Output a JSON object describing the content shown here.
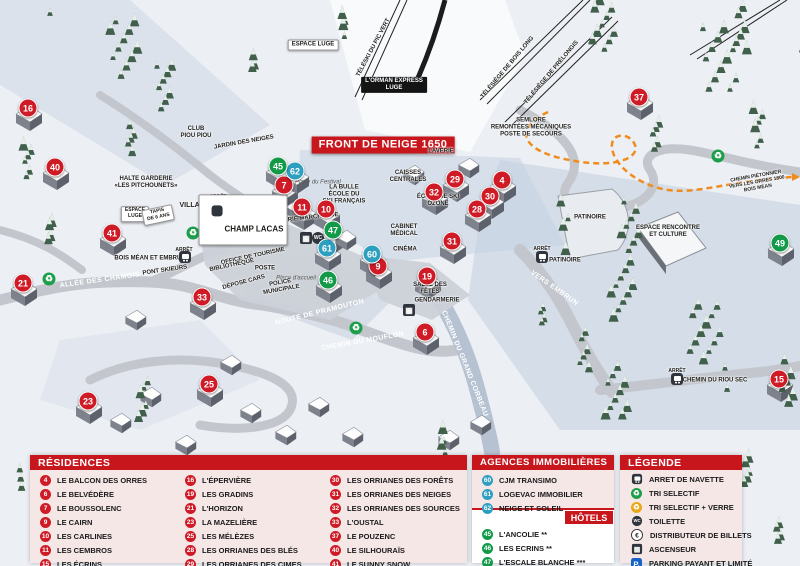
{
  "colors": {
    "residence": "#cf1b26",
    "agency": "#2d9fc0",
    "hotel": "#129a49",
    "header_red": "#c8161d",
    "panel_pink": "#f6e7e7",
    "path_orange": "#f08c1e"
  },
  "map": {
    "front_banner": "FRONT DE NEIGE 1650",
    "markers": [
      {
        "n": "16",
        "t": "residence",
        "x": 28,
        "y": 108
      },
      {
        "n": "40",
        "t": "residence",
        "x": 55,
        "y": 167
      },
      {
        "n": "41",
        "t": "residence",
        "x": 112,
        "y": 233
      },
      {
        "n": "21",
        "t": "residence",
        "x": 23,
        "y": 283
      },
      {
        "n": "33",
        "t": "residence",
        "x": 202,
        "y": 297
      },
      {
        "n": "23",
        "t": "residence",
        "x": 88,
        "y": 401
      },
      {
        "n": "25",
        "t": "residence",
        "x": 209,
        "y": 384
      },
      {
        "n": "7",
        "t": "residence",
        "x": 284,
        "y": 185
      },
      {
        "n": "11",
        "t": "residence",
        "x": 302,
        "y": 207
      },
      {
        "n": "10",
        "t": "residence",
        "x": 326,
        "y": 209
      },
      {
        "n": "9",
        "t": "residence",
        "x": 378,
        "y": 266
      },
      {
        "n": "29",
        "t": "residence",
        "x": 455,
        "y": 179
      },
      {
        "n": "32",
        "t": "residence",
        "x": 434,
        "y": 192
      },
      {
        "n": "4",
        "t": "residence",
        "x": 502,
        "y": 180
      },
      {
        "n": "30",
        "t": "residence",
        "x": 490,
        "y": 196
      },
      {
        "n": "28",
        "t": "residence",
        "x": 477,
        "y": 209
      },
      {
        "n": "31",
        "t": "residence",
        "x": 452,
        "y": 241
      },
      {
        "n": "19",
        "t": "residence",
        "x": 427,
        "y": 276
      },
      {
        "n": "6",
        "t": "residence",
        "x": 425,
        "y": 332
      },
      {
        "n": "37",
        "t": "residence",
        "x": 639,
        "y": 97
      },
      {
        "n": "15",
        "t": "residence",
        "x": 779,
        "y": 379
      },
      {
        "n": "62",
        "t": "agency",
        "x": 295,
        "y": 171
      },
      {
        "n": "61",
        "t": "agency",
        "x": 327,
        "y": 248
      },
      {
        "n": "60",
        "t": "agency",
        "x": 372,
        "y": 254
      },
      {
        "n": "45",
        "t": "hotel",
        "x": 278,
        "y": 166
      },
      {
        "n": "47",
        "t": "hotel",
        "x": 333,
        "y": 230
      },
      {
        "n": "46",
        "t": "hotel",
        "x": 328,
        "y": 280
      },
      {
        "n": "49",
        "t": "hotel",
        "x": 780,
        "y": 243
      }
    ],
    "labels": [
      {
        "text": "ESPACE LUGE",
        "x": 313,
        "y": 45,
        "style": "boxw",
        "size": 6
      },
      {
        "text": "TÉLÉSKI DU PIC VERT",
        "x": 374,
        "y": 48,
        "style": "plain",
        "rot": -62,
        "size": 6
      },
      {
        "text": "L'ORMAN EXPRESS\nLUGE",
        "x": 394,
        "y": 85,
        "style": "boxb",
        "size": 6
      },
      {
        "text": "TÉLÉSIÈGE DE BOIS LONG",
        "x": 508,
        "y": 68,
        "style": "plain",
        "rot": -50,
        "size": 6
      },
      {
        "text": "TÉLÉSIÈGE DE PRÉLONGIS",
        "x": 552,
        "y": 73,
        "style": "plain",
        "rot": -50,
        "size": 6
      },
      {
        "text": "FRONT DE NEIGE 1650",
        "x": 383,
        "y": 145,
        "style": "boxr",
        "size": 11
      },
      {
        "text": "SEMLORE\nREMONTÉES MÉCANIQUES\nPOSTE DE SECOURS",
        "x": 531,
        "y": 128,
        "style": "plain",
        "size": 6
      },
      {
        "text": "CLUB\nPIOU PIOU",
        "x": 196,
        "y": 133,
        "style": "plain",
        "size": 6
      },
      {
        "text": "JARDIN DES NEIGES",
        "x": 244,
        "y": 143,
        "style": "plain",
        "rot": -10,
        "size": 6
      },
      {
        "text": "HALTE GARDERIE\n«LES PITCHOUNETS»",
        "x": 146,
        "y": 183,
        "style": "plain",
        "size": 6
      },
      {
        "text": "VILLAGES",
        "x": 197,
        "y": 206,
        "style": "plain",
        "size": 7
      },
      {
        "text": "ARRÊT",
        "x": 218,
        "y": 198,
        "style": "tiny",
        "size": 5
      },
      {
        "text": "ESPACE\nLUGE",
        "x": 135,
        "y": 214,
        "style": "boxw",
        "size": 5
      },
      {
        "text": "TAPIS\nDE 6 ANS",
        "x": 158,
        "y": 215,
        "style": "boxw",
        "rot": -12,
        "size": 5
      },
      {
        "text": "LA BULLE\nÉCOLE DU\nSKI FRANÇAIS",
        "x": 344,
        "y": 195,
        "style": "plain",
        "size": 6
      },
      {
        "text": "Place du Festival",
        "x": 318,
        "y": 183,
        "style": "italic",
        "size": 6
      },
      {
        "text": "GALERIE MARCHANDE",
        "x": 305,
        "y": 219,
        "style": "plain",
        "rot": -6,
        "size": 6
      },
      {
        "text": "CAISSES\nCENTRALES",
        "x": 408,
        "y": 177,
        "style": "plain",
        "size": 6
      },
      {
        "text": "LAVERIE",
        "x": 441,
        "y": 152,
        "style": "plain",
        "size": 6
      },
      {
        "text": "ÉCOLE DE SKI\nOZONE",
        "x": 438,
        "y": 201,
        "style": "plain",
        "size": 6
      },
      {
        "text": "CABINET\nMÉDICAL",
        "x": 404,
        "y": 231,
        "style": "plain",
        "size": 6
      },
      {
        "text": "CINÉMA",
        "x": 405,
        "y": 250,
        "style": "plain",
        "size": 6
      },
      {
        "text": "Place d'accueil",
        "x": 296,
        "y": 279,
        "style": "italic",
        "size": 6
      },
      {
        "text": "OFFICE DE TOURISME",
        "x": 253,
        "y": 257,
        "style": "plain",
        "rot": -12,
        "size": 6
      },
      {
        "text": "BIBLIOTHÈQUE",
        "x": 232,
        "y": 266,
        "style": "plain",
        "rot": -12,
        "size": 6
      },
      {
        "text": "POSTE",
        "x": 265,
        "y": 269,
        "style": "plain",
        "size": 6
      },
      {
        "text": "DÉPOSE CARS",
        "x": 244,
        "y": 283,
        "style": "plain",
        "rot": -15,
        "size": 6
      },
      {
        "text": "POLICE\nMUNICIPALE",
        "x": 281,
        "y": 287,
        "style": "plain",
        "rot": -10,
        "size": 6
      },
      {
        "text": "SALLE DES\nFÊTES",
        "x": 430,
        "y": 289,
        "style": "plain",
        "size": 6
      },
      {
        "text": "GENDARMERIE",
        "x": 437,
        "y": 301,
        "style": "plain",
        "size": 6
      },
      {
        "text": "BOIS MÉAN ET EMBRUN",
        "x": 150,
        "y": 259,
        "style": "plain",
        "size": 6
      },
      {
        "text": "ARRÊT",
        "x": 184,
        "y": 251,
        "style": "tiny",
        "size": 5
      },
      {
        "text": "PONT SKIEURS",
        "x": 165,
        "y": 271,
        "style": "plain",
        "rot": -8,
        "size": 6
      },
      {
        "text": "ALLÉE DES CHAMOIS",
        "x": 100,
        "y": 281,
        "style": "road",
        "rot": -8,
        "size": 7
      },
      {
        "text": "ROUTE DE PRAMOUTON",
        "x": 320,
        "y": 313,
        "style": "road",
        "rot": -14,
        "size": 7
      },
      {
        "text": "CHEMIN DU MOUFLON",
        "x": 363,
        "y": 342,
        "style": "road",
        "rot": -10,
        "size": 7
      },
      {
        "text": "CHEMIN DU GRAND CORBEAU",
        "x": 464,
        "y": 364,
        "style": "road",
        "rot": 68,
        "size": 7
      },
      {
        "text": "VERS EMBRUN",
        "x": 554,
        "y": 289,
        "style": "road",
        "rot": 35,
        "size": 7
      },
      {
        "text": "PATINOIRE",
        "x": 590,
        "y": 218,
        "style": "plain",
        "size": 6
      },
      {
        "text": "ARRÊT",
        "x": 542,
        "y": 250,
        "style": "tiny",
        "size": 5
      },
      {
        "text": "PATINOIRE",
        "x": 565,
        "y": 261,
        "style": "plain",
        "size": 6
      },
      {
        "text": "ESPACE RENCONTRE\nET CULTURE",
        "x": 668,
        "y": 232,
        "style": "plain",
        "size": 6
      },
      {
        "text": "CHEMIN PIÉTONNIER\nVERS LES ORRES 1800\nBOIS MÉAN",
        "x": 757,
        "y": 183,
        "style": "plain",
        "rot": -10,
        "size": 5
      },
      {
        "text": "ARRÊT",
        "x": 677,
        "y": 372,
        "style": "tiny",
        "size": 5
      },
      {
        "text": "CHEMIN DU RIOU SEC",
        "x": 715,
        "y": 381,
        "style": "plain",
        "size": 6
      }
    ],
    "bus_stop_box": {
      "text": "CHAMP LACAS",
      "x": 243,
      "y": 220,
      "size": 8
    },
    "icons": [
      {
        "type": "bus",
        "name": "bus-stop-villages-icon",
        "x": 218,
        "y": 206
      },
      {
        "type": "bus",
        "name": "bus-stop-bois-mean-icon",
        "x": 185,
        "y": 257
      },
      {
        "type": "bus",
        "name": "bus-stop-patinoire-icon",
        "x": 542,
        "y": 257
      },
      {
        "type": "bus",
        "name": "bus-stop-riou-sec-icon",
        "x": 677,
        "y": 379
      },
      {
        "type": "recg",
        "name": "recycle-icon",
        "x": 49,
        "y": 279
      },
      {
        "type": "recg",
        "name": "recycle-icon",
        "x": 193,
        "y": 233
      },
      {
        "type": "recg",
        "name": "recycle-icon",
        "x": 356,
        "y": 328
      },
      {
        "type": "recg",
        "name": "recycle-icon",
        "x": 718,
        "y": 156
      },
      {
        "type": "recy",
        "name": "recycle-glass-icon",
        "x": 247,
        "y": 236
      },
      {
        "type": "park",
        "name": "parking-icon",
        "x": 264,
        "y": 237
      },
      {
        "type": "euro",
        "name": "atm-icon",
        "x": 276,
        "y": 222
      },
      {
        "type": "elev",
        "name": "elevator-icon",
        "x": 306,
        "y": 238
      },
      {
        "type": "elev",
        "name": "elevator-icon",
        "x": 409,
        "y": 310
      },
      {
        "type": "toil",
        "name": "toilet-icon",
        "x": 318,
        "y": 238
      }
    ]
  },
  "legend": {
    "residences": {
      "title": "RÉSIDENCES",
      "items": [
        {
          "num": "4",
          "name": "LE BALCON DES ORRES"
        },
        {
          "num": "6",
          "name": "LE BELVÉDÈRE"
        },
        {
          "num": "7",
          "name": "LE BOUSSOLENC"
        },
        {
          "num": "9",
          "name": "LE CAIRN"
        },
        {
          "num": "10",
          "name": "LES CARLINES"
        },
        {
          "num": "11",
          "name": "LES CEMBROS"
        },
        {
          "num": "15",
          "name": "LES ÉCRINS"
        },
        {
          "num": "16",
          "name": "L'ÉPERVIÈRE"
        },
        {
          "num": "19",
          "name": "LES GRADINS"
        },
        {
          "num": "21",
          "name": "L'HORIZON"
        },
        {
          "num": "23",
          "name": "LA MAZELIÈRE"
        },
        {
          "num": "25",
          "name": "LES MÉLÈZES"
        },
        {
          "num": "28",
          "name": "LES ORRIANES DES BLÉS"
        },
        {
          "num": "29",
          "name": "LES ORRIANES DES CIMES"
        },
        {
          "num": "30",
          "name": "LES ORRIANES DES FORÊTS"
        },
        {
          "num": "31",
          "name": "LES ORRIANES DES NEIGES"
        },
        {
          "num": "32",
          "name": "LES ORRIANES DES SOURCES"
        },
        {
          "num": "33",
          "name": "L'OUSTAL"
        },
        {
          "num": "37",
          "name": "LE POUZENC"
        },
        {
          "num": "40",
          "name": "LE SILHOURAÏS"
        },
        {
          "num": "41",
          "name": "LE SUNNY SNOW"
        }
      ]
    },
    "agencies": {
      "title": "AGENCES IMMOBILIÈRES",
      "items": [
        {
          "num": "60",
          "name": "CJM TRANSIMO"
        },
        {
          "num": "61",
          "name": "LOGEVAC IMMOBILIER"
        },
        {
          "num": "62",
          "name": "NEIGE ET SOLEIL"
        }
      ]
    },
    "hotels": {
      "title": "HÔTELS",
      "items": [
        {
          "num": "45",
          "name": "L'ANCOLIE **"
        },
        {
          "num": "46",
          "name": "LES ECRINS **"
        },
        {
          "num": "47",
          "name": "L'ESCALE BLANCHE ***"
        },
        {
          "num": "49",
          "name": "LES TRAPPEURS **"
        }
      ]
    },
    "key": {
      "title": "LÉGENDE",
      "items": [
        {
          "icon": "bus",
          "label": "ARRET DE NAVETTE"
        },
        {
          "icon": "recg",
          "label": "TRI SELECTIF"
        },
        {
          "icon": "recy",
          "label": "TRI SELECTIF + VERRE"
        },
        {
          "icon": "toil",
          "label": "TOILETTE"
        },
        {
          "icon": "euro",
          "label": "DISTRIBUTEUR DE BILLETS"
        },
        {
          "icon": "elev",
          "label": "ASCENSEUR"
        },
        {
          "icon": "park",
          "label": "PARKING PAYANT ET LIMITÉ"
        }
      ]
    }
  }
}
